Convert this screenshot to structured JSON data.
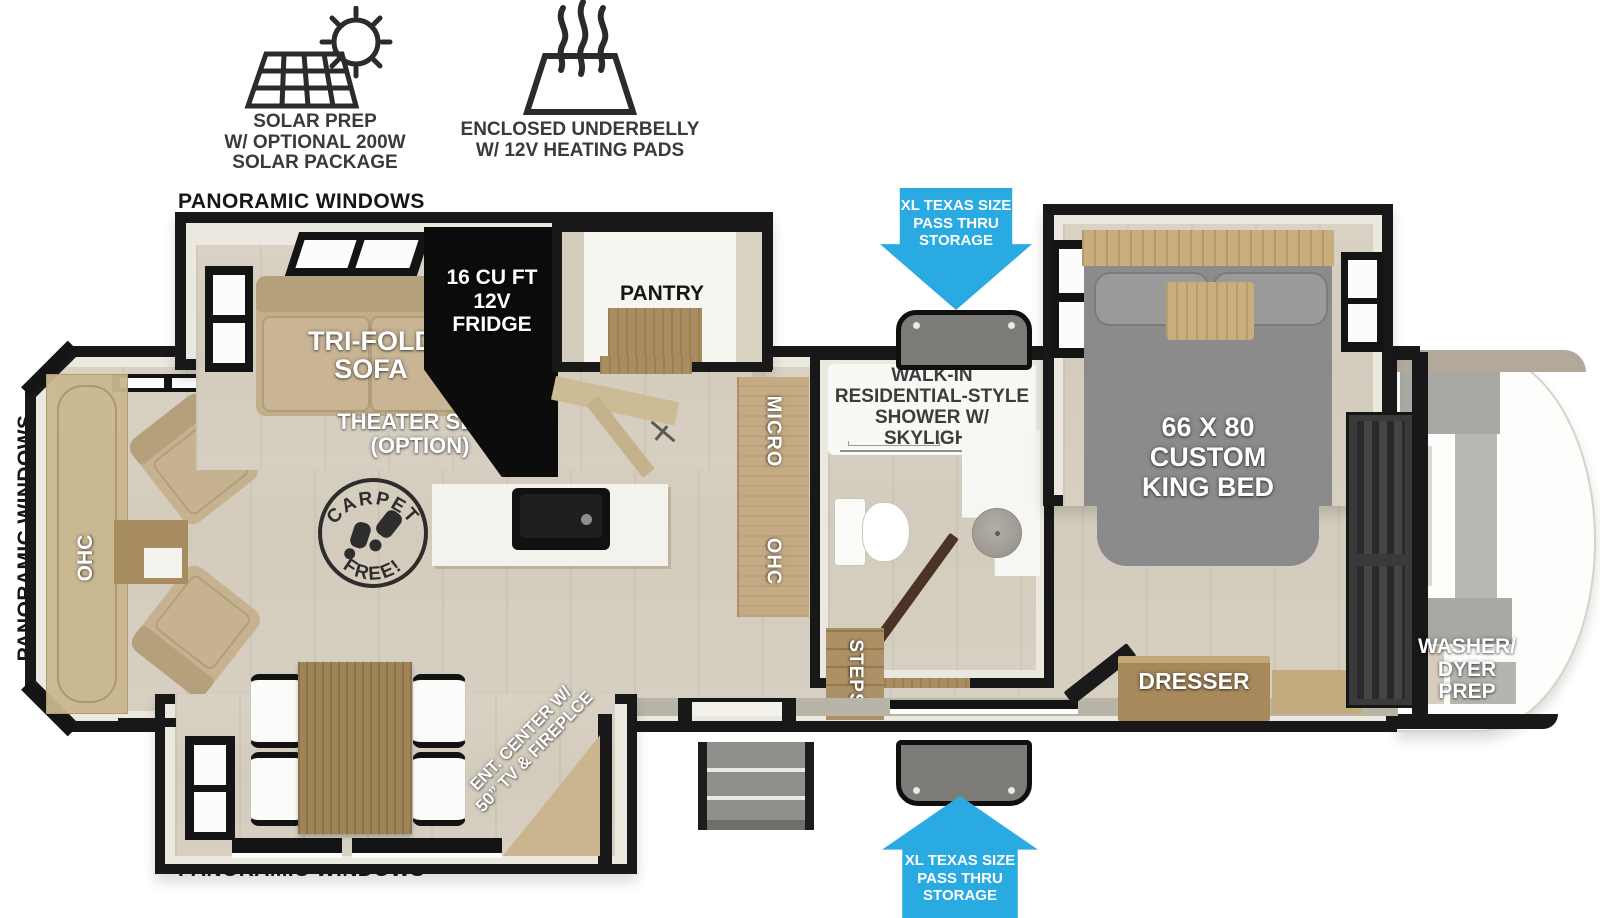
{
  "legend": {
    "solar": {
      "icon": "solar-panel-sun-icon",
      "lines": [
        "SOLAR PREP",
        "W/ OPTIONAL 200W",
        "SOLAR PACKAGE"
      ]
    },
    "underbelly": {
      "icon": "heating-pad-icon",
      "lines": [
        "ENCLOSED UNDERBELLY",
        "W/ 12V HEATING PADS"
      ]
    }
  },
  "storage_callouts": {
    "arrow_color": "#29abe2",
    "top": {
      "lines": [
        "XL TEXAS SIZE",
        "PASS THRU",
        "STORAGE"
      ]
    },
    "bottom": {
      "lines": [
        "XL TEXAS SIZE",
        "PASS THRU",
        "STORAGE"
      ]
    }
  },
  "window_labels": {
    "top": "PANORAMIC WINDOWS",
    "left": "PANORAMIC WINDOWS",
    "bottom": "PANORAMIC WINDOWS"
  },
  "living": {
    "sofa": {
      "lines": [
        "TRI-FOLD",
        "SOFA"
      ]
    },
    "theater": {
      "lines": [
        "THEATER SEAT",
        "(OPTION)"
      ]
    },
    "rear_cabinet": "OHC",
    "carpet_badge": {
      "top": "CARPET",
      "bottom": "FREE!"
    },
    "ent_center": {
      "lines": [
        "ENT. CENTER W/",
        "50” TV & FIREPLCE"
      ]
    }
  },
  "kitchen": {
    "fridge": {
      "lines": [
        "16 CU FT",
        "12V",
        "FRIDGE"
      ]
    },
    "pantry": "PANTRY",
    "micro": "MICRO",
    "ohc": "OHC"
  },
  "bath": {
    "shower": {
      "lines": [
        "WALK-IN",
        "RESIDENTIAL-STYLE",
        "SHOWER W/",
        "SKYLIGHT"
      ]
    },
    "steps": "STEPS"
  },
  "bedroom": {
    "bed": {
      "lines": [
        "66 X 80",
        "CUSTOM",
        "KING BED"
      ]
    },
    "dresser": "DRESSER"
  },
  "front_cap": {
    "washer": {
      "lines": [
        "WASHER/",
        "DYER",
        "PREP"
      ]
    }
  }
}
